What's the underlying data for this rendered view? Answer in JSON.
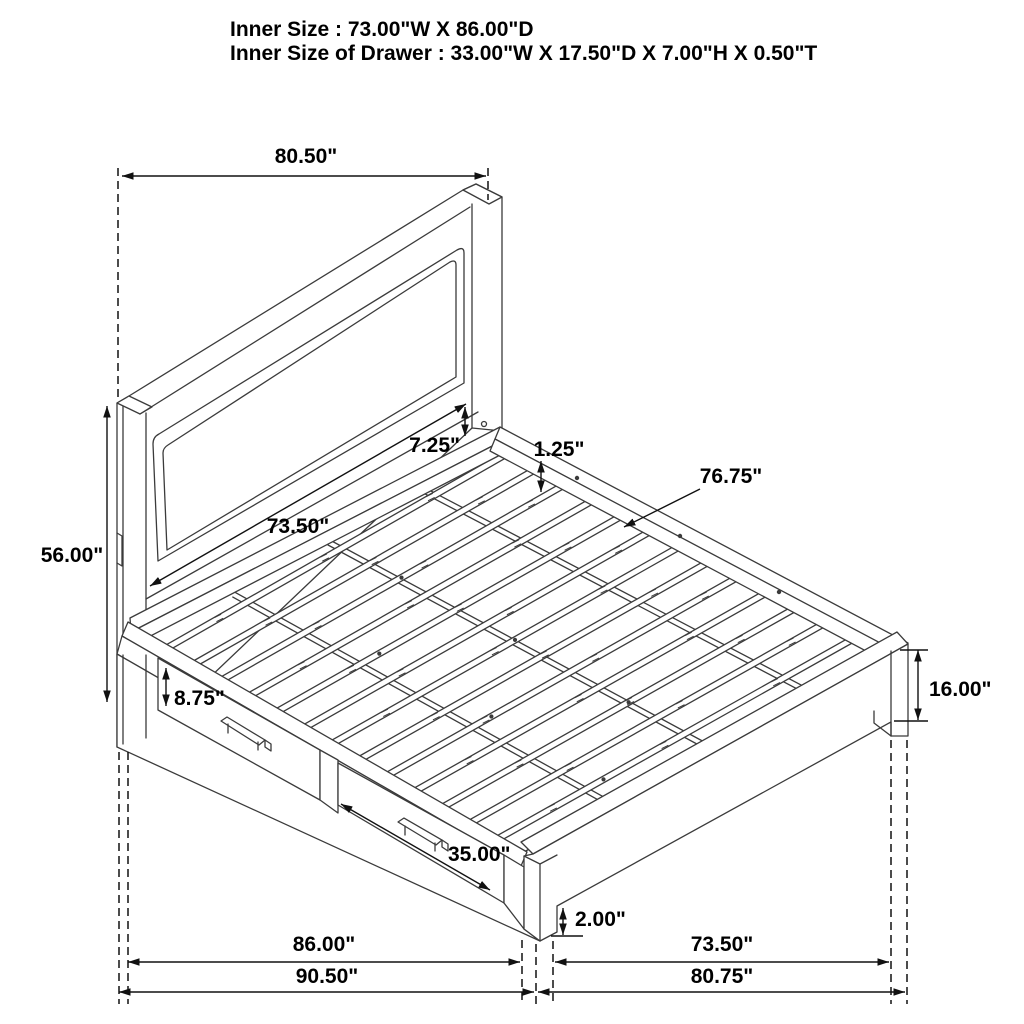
{
  "page": {
    "background": "#ffffff",
    "line_color": "#3b3b3b",
    "dimension_color": "#111111"
  },
  "header": {
    "line1": "Inner Size : 73.00\"W X 86.00\"D",
    "line2": "Inner Size of Drawer : 33.00\"W X 17.50\"D X 7.00\"H X 0.50\"T"
  },
  "dimensions": {
    "headboard_width": "80.50\"",
    "panel_inset": "7.25\"",
    "rail_thickness": "1.25\"",
    "slat_length": "76.75\"",
    "headboard_panel_width": "73.50\"",
    "headboard_height": "56.00\"",
    "drawer_opening_height": "8.75\"",
    "footboard_height": "16.00\"",
    "drawer_front_width": "35.00\"",
    "ground_clearance": "2.00\"",
    "side_inner_length": "86.00\"",
    "side_outer_length": "90.50\"",
    "foot_inner_width": "73.50\"",
    "foot_outer_width": "80.75\""
  }
}
